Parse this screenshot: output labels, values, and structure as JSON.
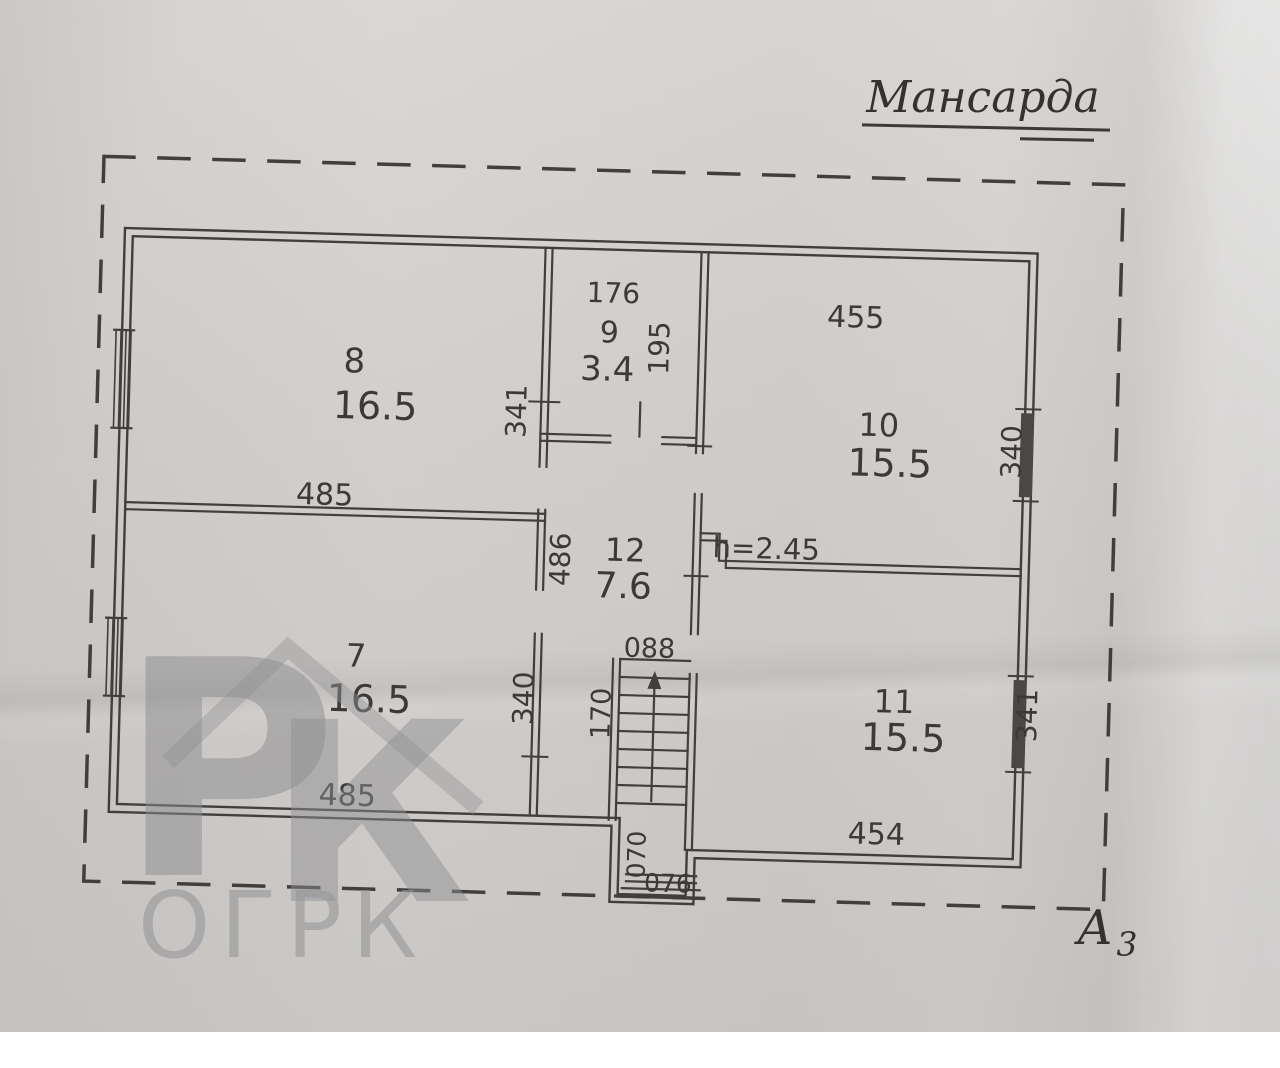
{
  "document": {
    "title": "Мансарда",
    "sheet_label": {
      "letter": "А",
      "index": "3"
    },
    "watermark": {
      "logo_letter_p": "Р",
      "logo_letter_k": "К",
      "org_text": "ОГРК"
    }
  },
  "plan": {
    "floor_name": "Мансарда",
    "rooms": [
      {
        "number": "7",
        "area": "16.5"
      },
      {
        "number": "8",
        "area": "16.5"
      },
      {
        "number": "9",
        "area": "3.4"
      },
      {
        "number": "10",
        "area": "15.5"
      },
      {
        "number": "11",
        "area": "15.5"
      },
      {
        "number": "12",
        "area": "7.6"
      }
    ],
    "dimensions": {
      "room8_width": "485",
      "room8_depth": "341",
      "room9_width": "176",
      "room9_depth": "195",
      "room10_width": "455",
      "room10_depth": "340",
      "room11_width": "454",
      "room11_depth": "341",
      "room7_width": "485",
      "room7_depth": "340",
      "hall12_depth": "486",
      "stairs_width": "088",
      "stairs_length": "170",
      "exit_depth": "070",
      "exit_width": "076",
      "ceiling_height": "h=2.45"
    },
    "ink_color": "#3f3e3b",
    "paper_color": "#d4d2cf"
  }
}
